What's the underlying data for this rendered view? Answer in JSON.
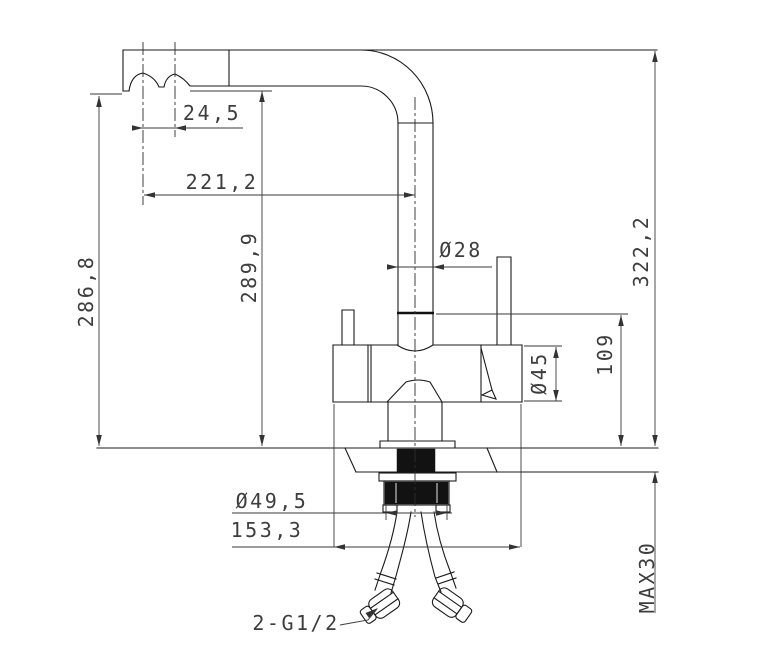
{
  "drawing": {
    "colors": {
      "background": "#ffffff",
      "line": "#1b1b1b",
      "dimension_text": "#3d3d3d"
    },
    "dimensions": {
      "aerator_spacing": "24,5",
      "spout_reach": "221,2",
      "aerator_height": "286,8",
      "spout_underside_height": "289,9",
      "overall_height": "322,2",
      "spout_tube_diameter": "Ø28",
      "body_diameter": "Ø45",
      "body_top_height": "109",
      "mounting_shank_diameter": "Ø49,5",
      "body_length": "153,3",
      "max_deck_thickness": "MAX30",
      "hose_connection": "2-G1/2"
    }
  }
}
